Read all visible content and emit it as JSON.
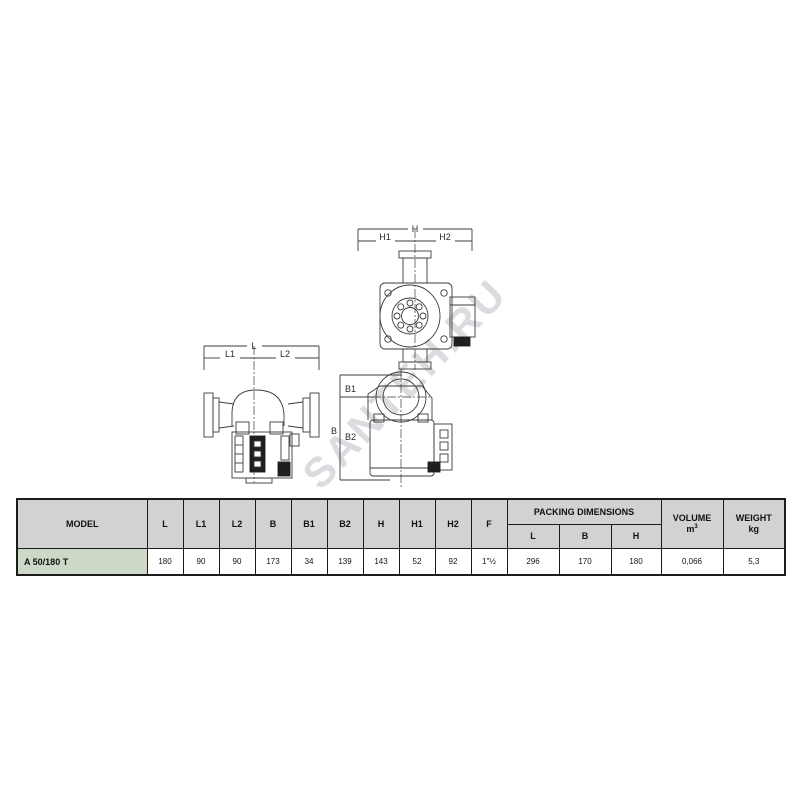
{
  "watermark": "SANTEH.RU",
  "drawings": {
    "front_view": {
      "total": "H",
      "part1": "H1",
      "part2": "H2"
    },
    "side_view": {
      "total": "L",
      "part1": "L1",
      "part2": "L2"
    },
    "top_view": {
      "total": "B",
      "part1": "B1",
      "part2": "B2"
    }
  },
  "table": {
    "headers": {
      "model": "MODEL",
      "dims": [
        "L",
        "L1",
        "L2",
        "B",
        "B1",
        "B2",
        "H",
        "H1",
        "H2",
        "F"
      ],
      "packing": "PACKING DIMENSIONS",
      "packing_sub": [
        "L",
        "B",
        "H"
      ],
      "volume_line1": "VOLUME",
      "volume_unit": "m",
      "volume_sup": "3",
      "weight_line1": "WEIGHT",
      "weight_line2": "kg"
    },
    "row": {
      "model": "A 50/180 T",
      "values": [
        "180",
        "90",
        "90",
        "173",
        "34",
        "139",
        "143",
        "52",
        "92",
        "1\"½",
        "296",
        "170",
        "180",
        "0,066",
        "5,3"
      ]
    }
  },
  "colors": {
    "header_bg": "#d2d2d2",
    "model_bg": "#cdd9c7",
    "table_border": "#1c1c1c",
    "drawing_line": "#3b3b3b",
    "watermark": "#9ea4ac"
  }
}
